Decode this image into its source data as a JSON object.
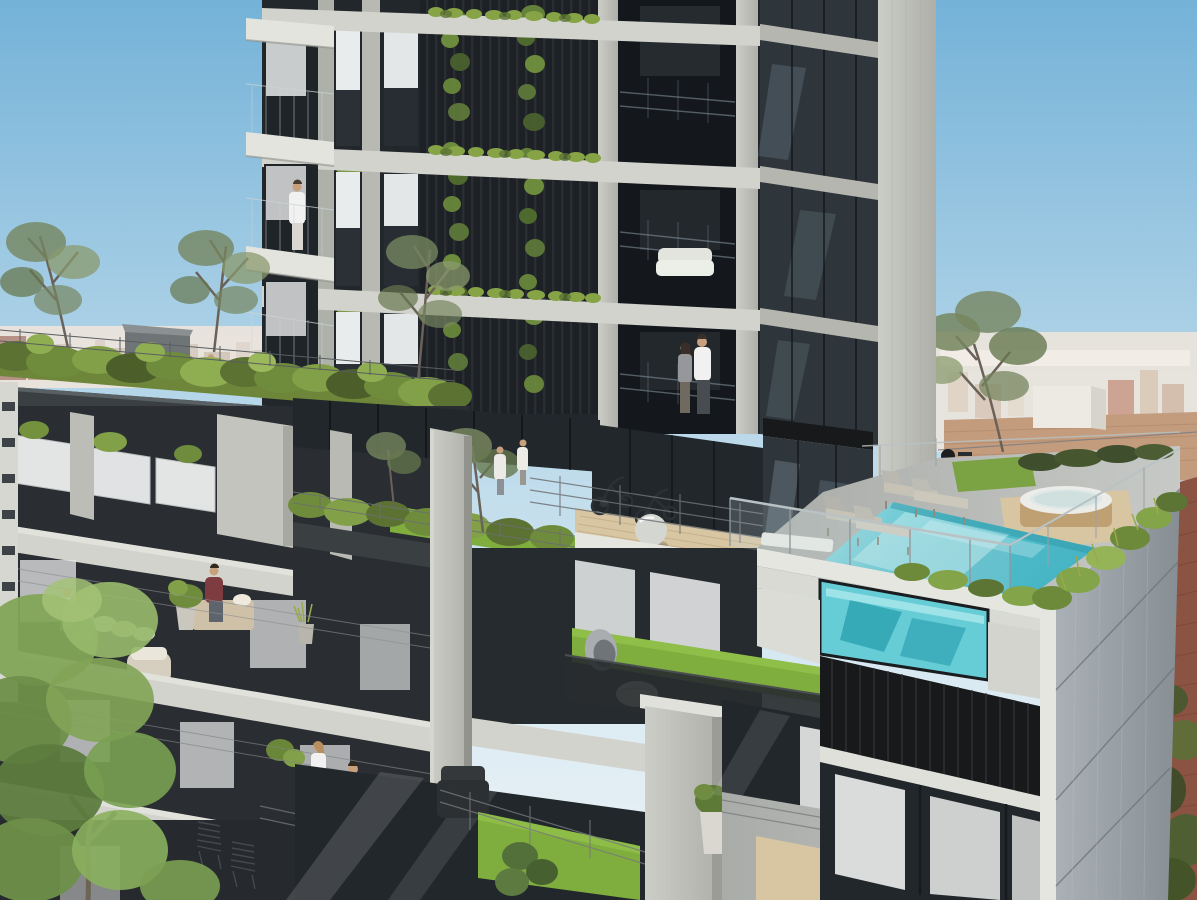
{
  "scene": {
    "type": "architectural rendering",
    "description": "Photorealistic daytime rendering of a modern concrete-and-glass residential tower rising from a stepped podium with planted terraces, a landscaped roof garden, an outdoor fitness deck with exercise bikes, an amenity garden, and a rooftop swimming pool with a transparent acrylic side wall and round wooden hot tub. Small human figures occupy balconies and decks; a hazy low-rise city skyline and brick neighbor buildings fill the background under a clear blue sky.",
    "time_of_day": "day, clear sky, sunlight from upper right"
  },
  "palette": {
    "sky_top": "#74b2d8",
    "sky_low": "#dcebf3",
    "haze_city": "#ece4dc",
    "brick_far": "#c39b7d",
    "brick_near": "#8a5342",
    "concrete_light": "#d3d3cd",
    "concrete_mid": "#b8b9b3",
    "concrete_side": "#9aa3ab",
    "slab_white": "#e6e6e0",
    "glass_dark": "#22272c",
    "louver_black": "#17191b",
    "planter_dark": "#3a3f42",
    "green_mid": "#6f8c3c",
    "green_bright": "#8fae52",
    "grass": "#7fae3e",
    "wood_deck": "#d8c5a2",
    "hot_tub_wood": "#bfa073",
    "pool_water": "#53bfcc",
    "pool_window": "#66ccd6",
    "maroon_shirt": "#7e3b40"
  },
  "background": {
    "sky": "clear blue gradient, lighter toward horizon",
    "skyline_left": "hazy low-rise cityscape with scattered red-brick buildings",
    "skyline_right": "pale sunlit city haze behind tan brick parapet wall",
    "white_rooftop_box": "white penthouse volume on neighboring roof",
    "neighbor_right": "dark red brick party wall with ivy at its base"
  },
  "building": {
    "tower": {
      "floors_visible": 3,
      "left_bays": "projecting balconies with glass railings and roller blinds",
      "center_bays": "black vertical louvers with climbing green vines and planter boxes on each slab edge",
      "right_bays": "recessed balconies behind glass balustrades, white sofa on one balcony",
      "side_face": "dark glazing with concrete slab bands and a wide sunlit concrete pier"
    },
    "podium": {
      "roof_garden": "dense shrubs, slender trees, wire railing, dark planter fascia, gray pavilion",
      "left_wing": "diagonal balcony slabs with translucent white railing panels, plants and furniture",
      "amenity_level": "indoor gym behind glazing, outdoor wooden fitness deck, planted garden terrace",
      "pool_deck": "gray stone deck with loungers, glass guardrail, hedge, hot tub on timber platform",
      "lower_terraces": "private patios with artificial-grass squares, mesh railings, potted plants",
      "pool_window": "turquoise acrylic panel revealing pool water from the floor below",
      "louver_screen": "black slatted screen band on the front facade"
    }
  },
  "people": [
    {
      "location": "tower left balcony, 3rd visible floor",
      "activity": "standing at railing",
      "clothing": "white robe"
    },
    {
      "location": "tower recessed balcony, lowest floor",
      "activity": "couple standing together",
      "clothing": "white t-shirt and dark pants; gray top"
    },
    {
      "location": "amenity garden",
      "activity": "walking",
      "clothing": "white coat"
    },
    {
      "location": "amenity garden, near tree",
      "activity": "walking",
      "clothing": "white outfit"
    },
    {
      "location": "roof garden path",
      "activity": "strolling",
      "clothing": "pink top, jeans"
    },
    {
      "location": "roof garden path, center",
      "activity": "strolling",
      "clothing": "white top"
    },
    {
      "location": "roof garden path, right",
      "activity": "strolling",
      "clothing": "teal top"
    },
    {
      "location": "left wing balcony",
      "activity": "seated at small table",
      "clothing": "white shirt"
    },
    {
      "location": "left wing balcony",
      "activity": "seated at small table",
      "clothing": "light dress, dark hair"
    },
    {
      "location": "left wing balcony bench",
      "activity": "seated reading",
      "clothing": "maroon t-shirt"
    },
    {
      "location": "lower right balcony",
      "activity": "standing, facing right",
      "clothing": "white top, tan trousers"
    },
    {
      "location": "lower right balcony",
      "activity": "standing, facing away",
      "clothing": "white shirt, gray shorts"
    }
  ],
  "objects": {
    "pool": 1,
    "hot_tub": 1,
    "sun_loungers": 4,
    "flat_bench": 1,
    "exercise_bikes": 2,
    "gym_ball": 1,
    "barbecue_grill": 1,
    "egg_chair": 1,
    "white_pouf": 1,
    "wicker_armchair": 1,
    "dark_armchair": 1,
    "metal_slat_chairs": 2,
    "white_sofa": 1,
    "potted_plants": 6,
    "bistro_table": 1
  },
  "vegetation": {
    "roof_garden_shrubs": "olive and bright green massing",
    "slender_trees": 5,
    "vine_strips_on_tower": 2,
    "balcony_planters": "green strips on every slab edge",
    "foreground_tree": "large fresh-green canopy, bottom left",
    "grass_patches": 3,
    "edge_planters_at_pool": "grasses along deck edges",
    "ivy_on_brick": "bottom right corner"
  }
}
